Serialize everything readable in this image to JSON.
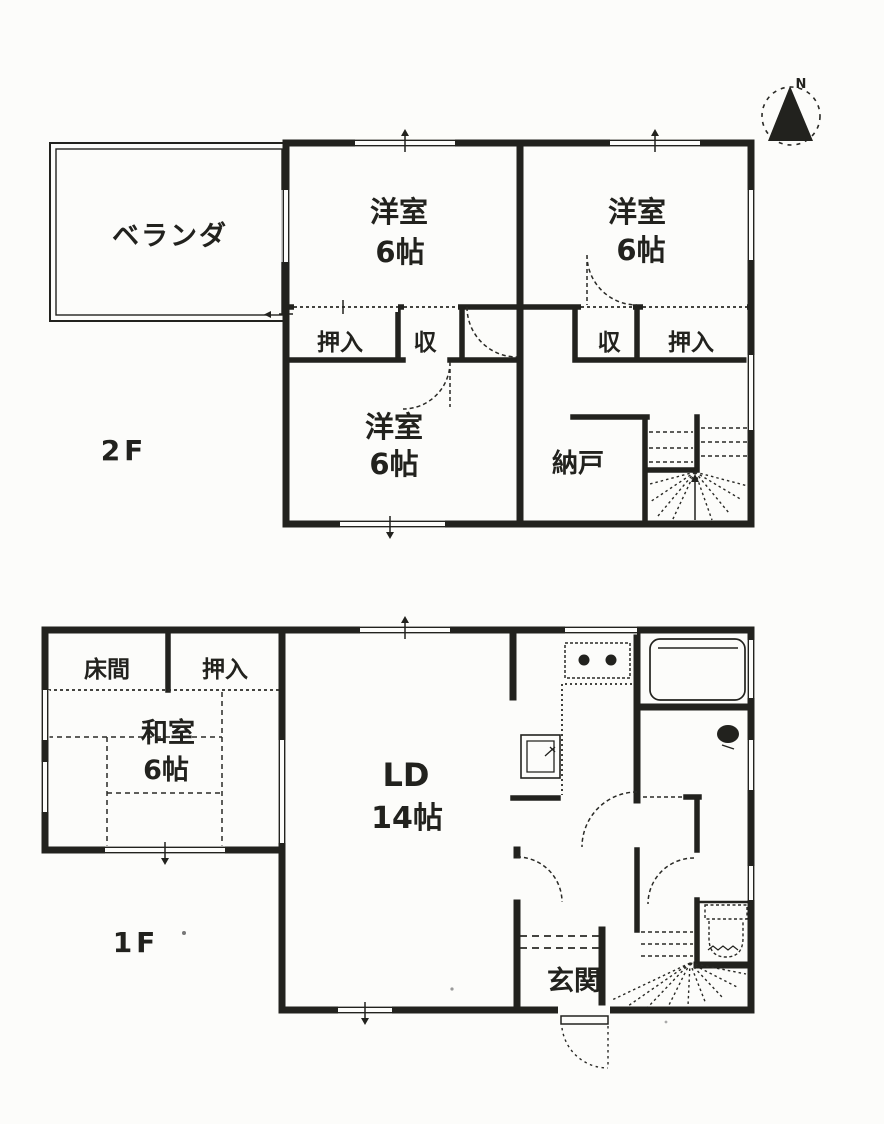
{
  "meta": {
    "document_type": "floor-plan",
    "colors": {
      "ink": "#22221e",
      "paper": "#fcfcfa"
    }
  },
  "compass": {
    "label": "N"
  },
  "floor2": {
    "floor_label": "2F",
    "veranda": "ベランダ",
    "room_nw": {
      "name": "洋室",
      "size": "6帖"
    },
    "room_ne": {
      "name": "洋室",
      "size": "6帖"
    },
    "room_sw": {
      "name": "洋室",
      "size": "6帖"
    },
    "closet_w": "押入",
    "storage_w": "収",
    "storage_e": "収",
    "closet_e": "押入",
    "storeroom": "納戸"
  },
  "floor1": {
    "floor_label": "1F",
    "tokonoma": "床間",
    "closet": "押入",
    "washitsu": {
      "name": "和室",
      "size": "6帖"
    },
    "ld": {
      "name": "LD",
      "size": "14帖"
    },
    "genkan": "玄関"
  }
}
